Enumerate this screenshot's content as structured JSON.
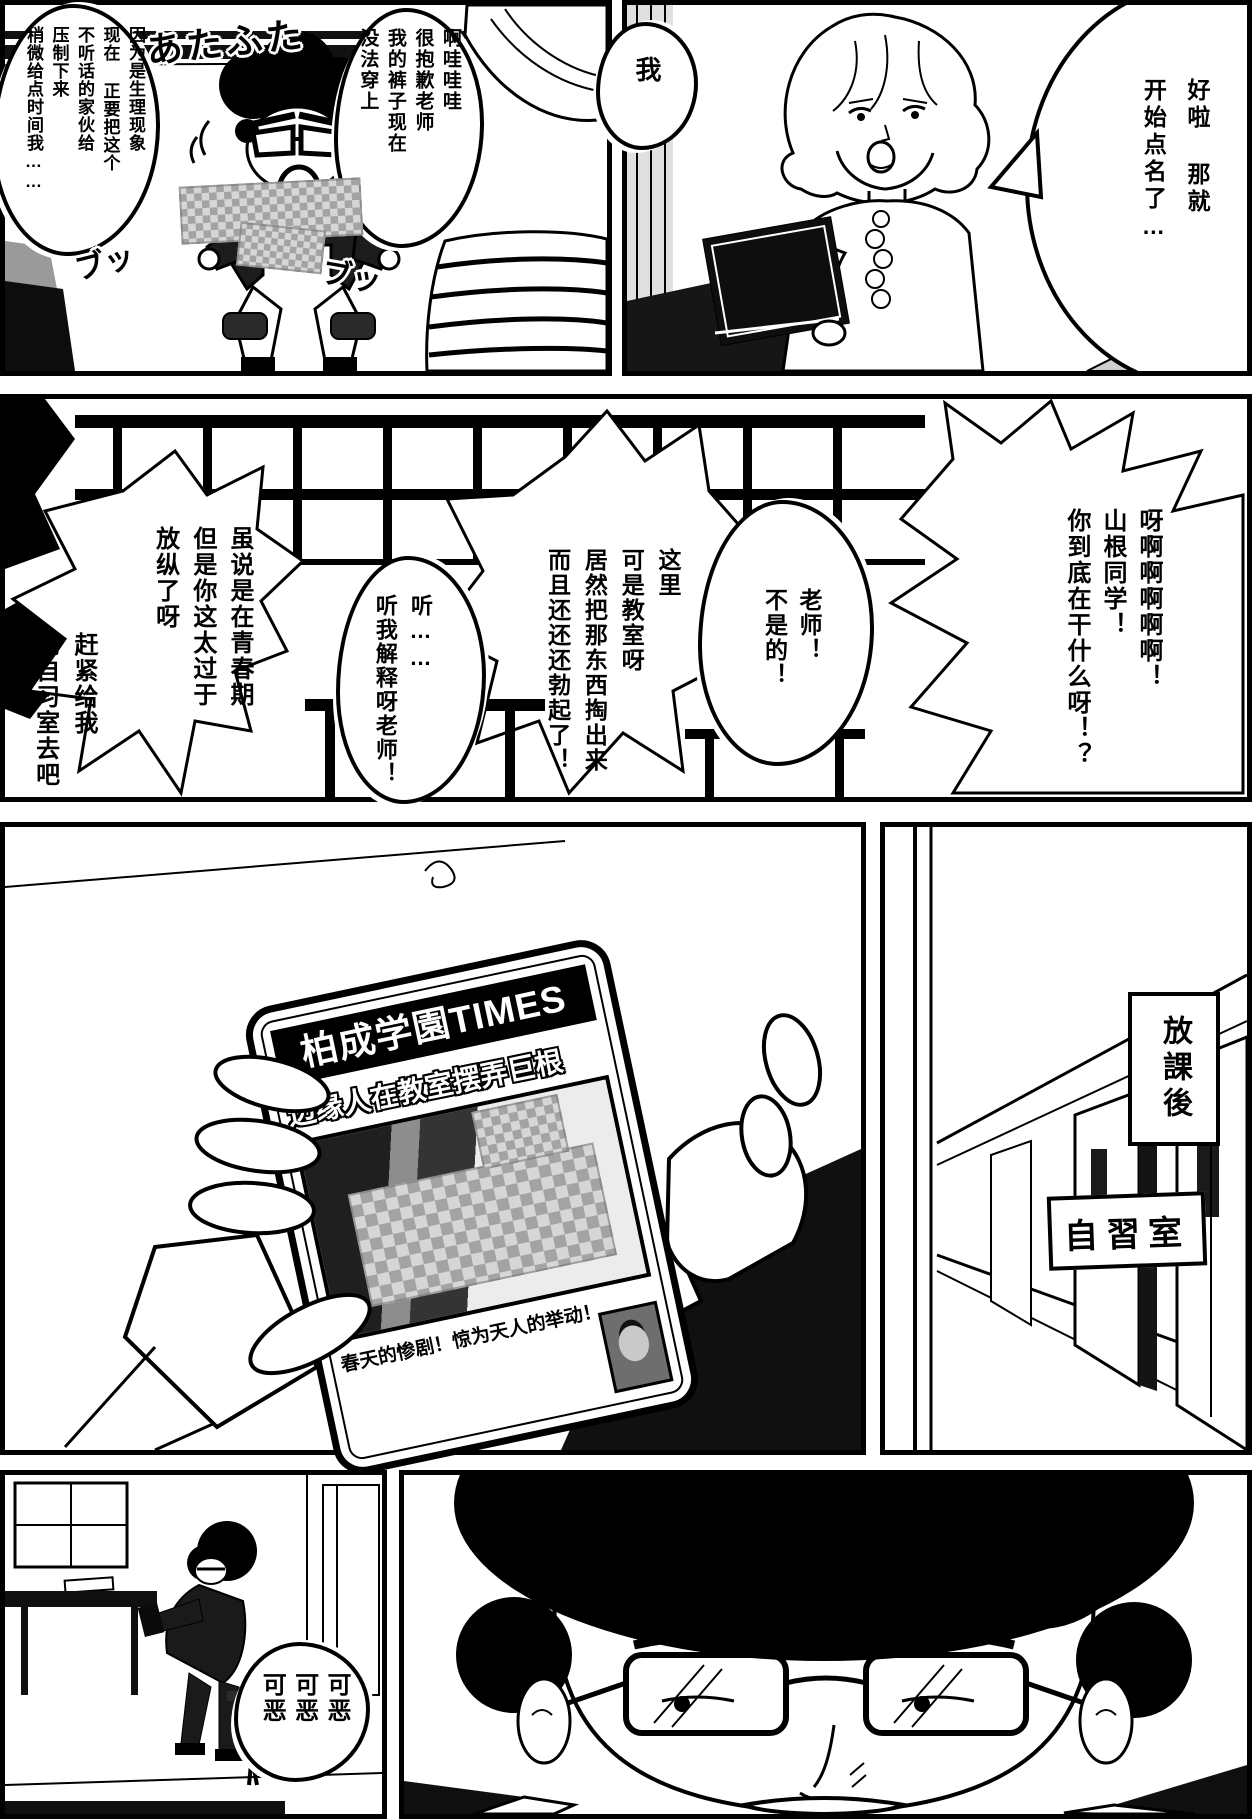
{
  "page_title": "manga-page",
  "colors": {
    "ink": "#000000",
    "paper": "#ffffff",
    "mosaic_dark": "#a3a3a3",
    "mosaic_light": "#d6d6d6"
  },
  "panels": {
    "teacher_intro": {
      "speech": "好啦 那就\n开始点名了…"
    },
    "classroom_flail": {
      "thought": "因为是生理现象\n现在 正要把这个\n不听话的家伙给\n压制下来\n稍微给点时间我……",
      "sfx_flustered": "あたふた",
      "sfx_pop_left": "ブッ",
      "sfx_pop_right": "ブッ",
      "apology": "啊哇哇哇\n很抱歉老师\n我的裤子现在\n没法穿上",
      "stammer": "我"
    },
    "scolding": {
      "scream": "呀啊啊啊啊啊！\n山根同学！\n你到底在干什么呀！？",
      "denial": "老师！\n不是的！",
      "accusation": "这里\n可是教室呀\n居然把那东西掏出来\n而且还还还勃起了！",
      "plea": "听……\n听我解释呀老师！",
      "lecture": "虽说是在青春期\n但是你这太过于\n放纵了呀",
      "order": "赶紧给我\n到自习室去吧"
    },
    "phone_news": {
      "masthead": "柏成学園TIMES",
      "headline": "边缘人在教室摆弄巨根",
      "caption": "春天的惨剧！惊为天人的举动！"
    },
    "hallway": {
      "caption_after_school": "放課後",
      "sign_study_room": "自習室"
    },
    "study_room": {
      "curse": "可恶\n可恶\n可恶"
    }
  }
}
